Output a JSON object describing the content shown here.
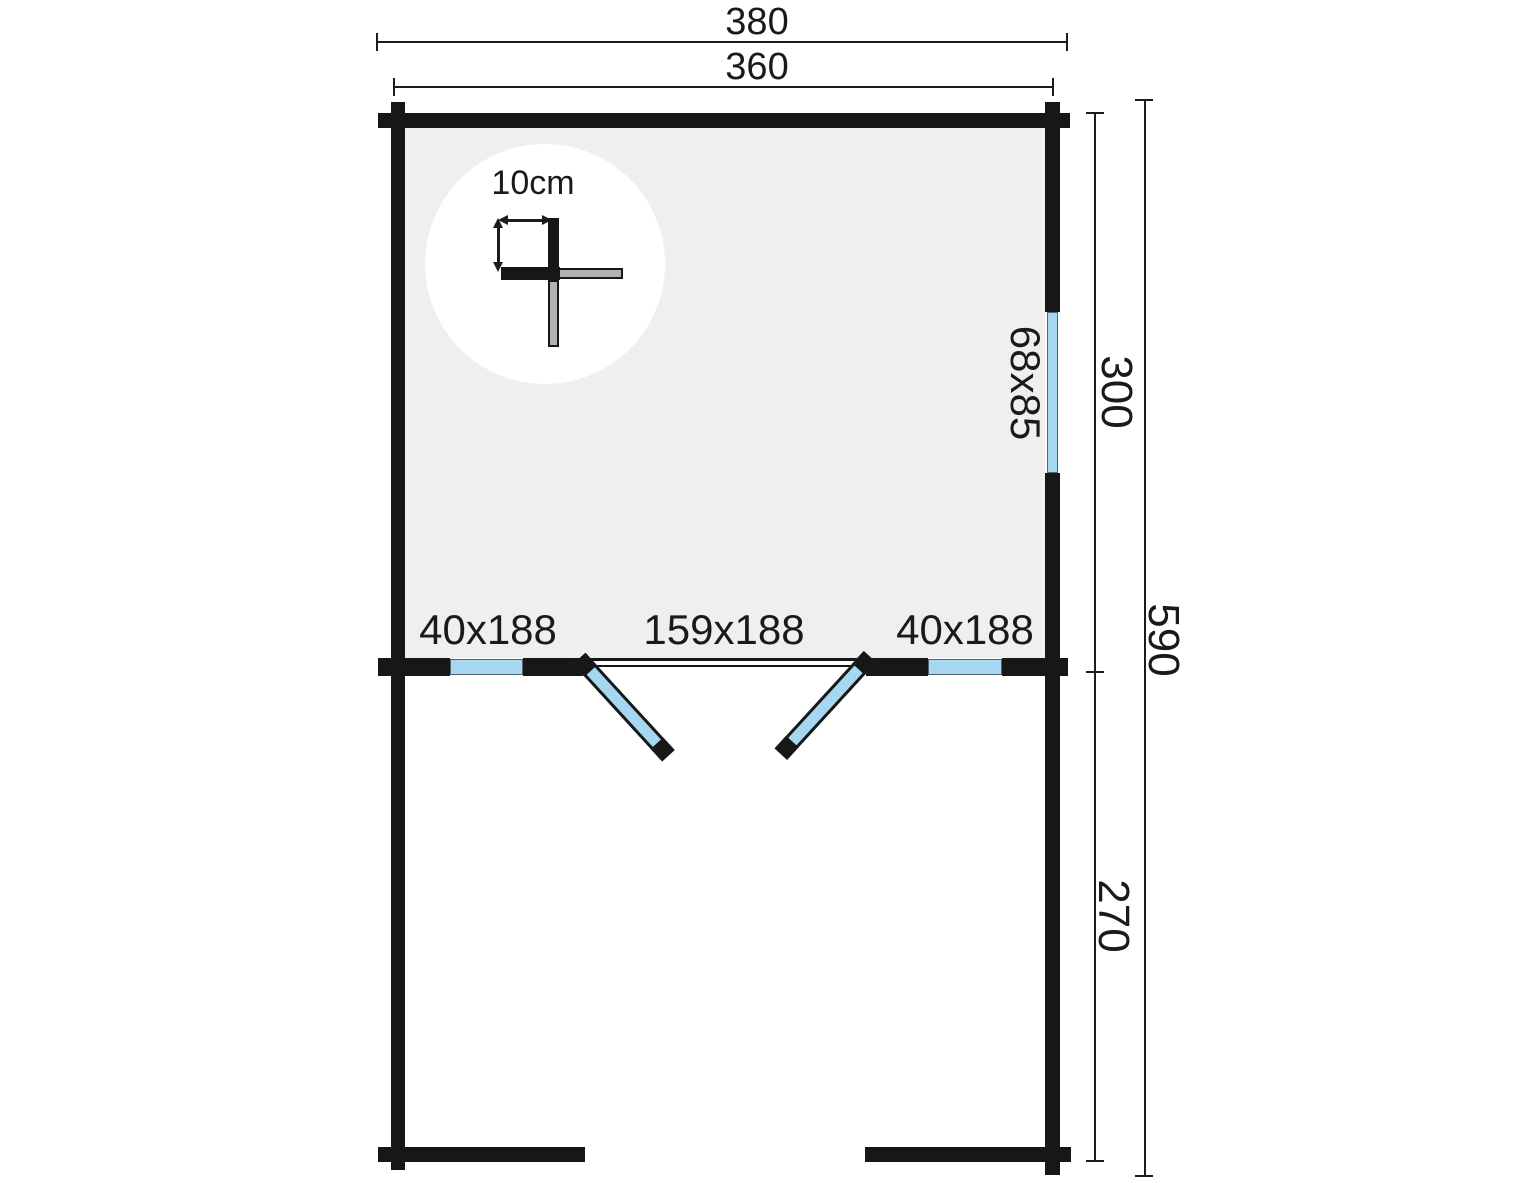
{
  "colors": {
    "wall": "#171717",
    "room_fill": "#efeff0",
    "glazing": "#a5d7f0",
    "glazing_edge": "#54646e",
    "log_end": "#b2b2b2",
    "dim": "#1c1c1c",
    "background": "#ffffff",
    "text": "#1a1a1a"
  },
  "dimensions": {
    "overall_width": "380",
    "wall_width": "360",
    "room_depth": "300",
    "total_depth": "590",
    "terrace_depth": "270"
  },
  "openings": {
    "left_window": "40x188",
    "door": "159x188",
    "right_window": "40x188",
    "side_window": "68x85"
  },
  "detail": {
    "wall_thickness": "10cm"
  }
}
